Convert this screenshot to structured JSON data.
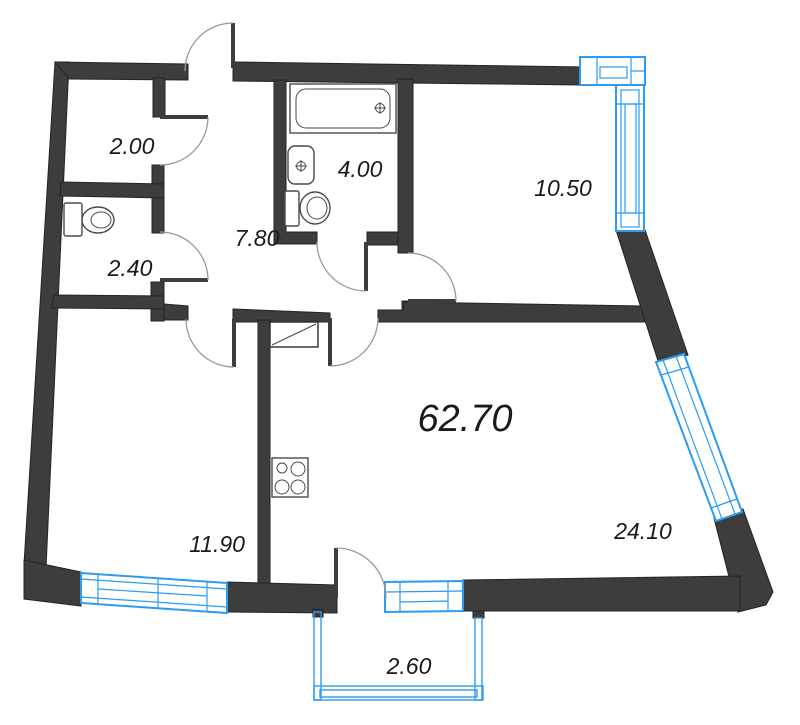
{
  "plan": {
    "type": "apartment-floor-plan",
    "units": "m2",
    "total_area": {
      "label": "62.70"
    },
    "rooms": [
      {
        "name": "storage-room",
        "area_label": "2.00"
      },
      {
        "name": "wc",
        "area_label": "2.40"
      },
      {
        "name": "hallway",
        "area_label": "7.80"
      },
      {
        "name": "bathroom",
        "area_label": "4.00"
      },
      {
        "name": "bedroom",
        "area_label": "10.50"
      },
      {
        "name": "room",
        "area_label": "11.90"
      },
      {
        "name": "kitchen-living-room",
        "area_label": "24.10"
      },
      {
        "name": "balcony",
        "area_label": "2.60"
      }
    ],
    "fixtures": [
      "bathtub",
      "wash-basin",
      "toilet-bathroom",
      "toilet-wc",
      "cooktop",
      "vent-shaft"
    ],
    "doors": [
      "entry-door",
      "storage-door",
      "wc-door",
      "bathroom-door",
      "bedroom-door",
      "kitchen-door",
      "room-door",
      "balcony-door"
    ],
    "windows": [
      "corner-window-top",
      "window-right",
      "window-diagonal",
      "window-bottom-left",
      "window-balcony"
    ],
    "colors": {
      "wall": "#3d3d3d",
      "window_frame": "#2d9bf0",
      "door_arc": "#9a9a9a",
      "label_text": "#1a1a1a",
      "background": "#ffffff"
    }
  }
}
